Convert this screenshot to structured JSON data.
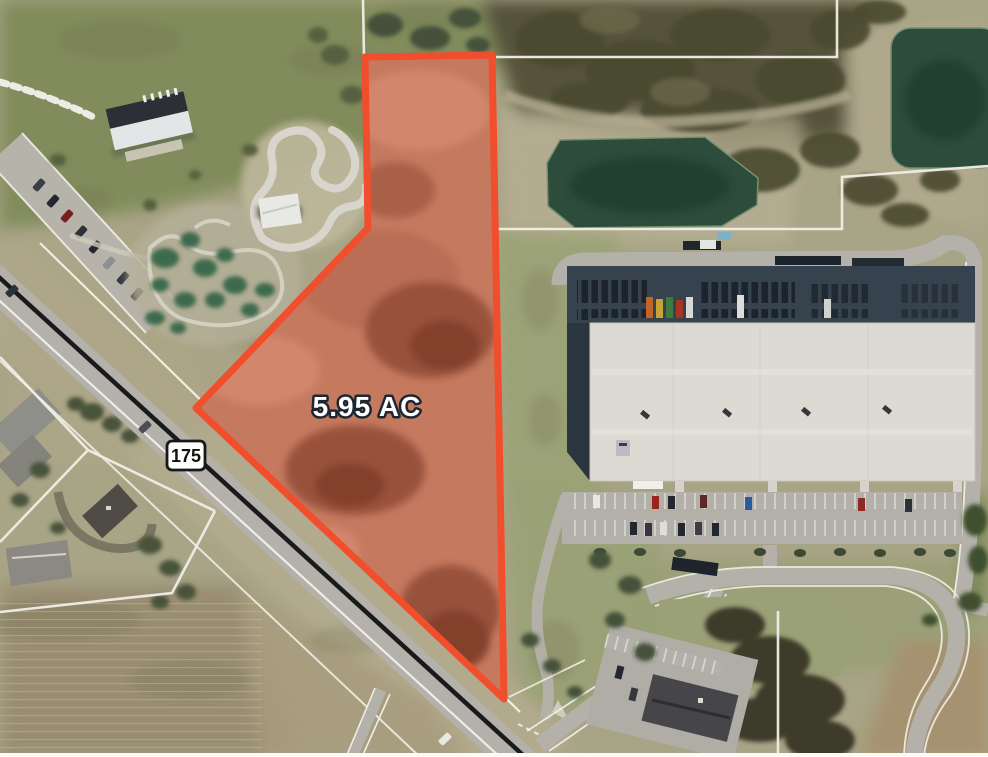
{
  "map": {
    "area_label": "5.95 AC",
    "route_shield_number": "175"
  },
  "colors": {
    "parcel_outline": "#f14e2d",
    "parcel_fill": "rgba(234,86,58,0.30)",
    "area_label_text": "#ffffff",
    "area_label_outline": "#1d2733",
    "shield_background": "#fdfdfb",
    "shield_border": "#17181a",
    "shield_text": "#111111",
    "boundary_line": "#f0eee6",
    "pond_water": "#2d4c3b",
    "road_surface": "#b4b1aa",
    "asphalt_stripe": "#191a1b",
    "warehouse_roof": "#dcdad2"
  }
}
